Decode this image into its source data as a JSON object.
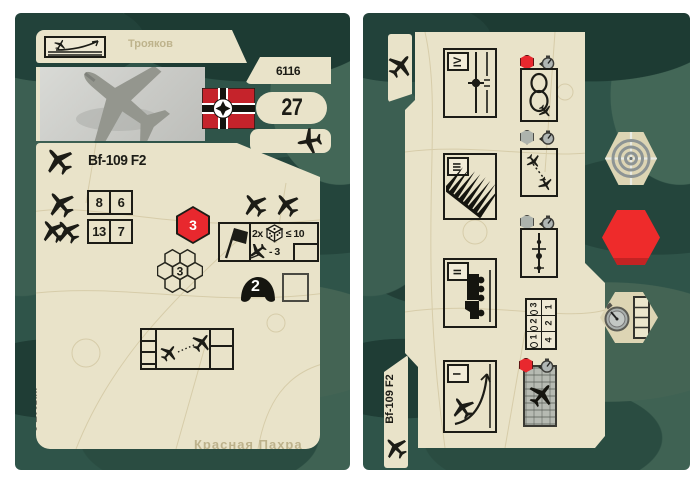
{
  "colors": {
    "page_bg": "#ffffff",
    "camo_base": "#2f5449",
    "camo_dark": "#1d3b33",
    "camo_light": "#436757",
    "card_beige": "#e9e3c9",
    "accent_red": "#e8282e",
    "ink": "#1c1c16"
  },
  "left_card": {
    "unit_code": "6116",
    "point_value": "27",
    "title": "Bf-109 F2",
    "icons": {
      "climb": "aircraft-climb-icon",
      "photo": "aircraft-photo",
      "flag": "german-war-flag-icon",
      "type": "aircraft-icon"
    },
    "stats": [
      {
        "icon": "single-aircraft-icon",
        "values": [
          "8",
          "6"
        ]
      },
      {
        "icon": "paired-aircraft-icon",
        "values": [
          "13",
          "7"
        ]
      }
    ],
    "initiative_hex": "3",
    "formation_hex": "3",
    "attack_panel": {
      "flag_icon": "assault-flag-icon",
      "multiplier": "2x",
      "dice_icon": "dice-icon",
      "threshold": "≤ 10",
      "strafe_icon": "strafing-aircraft-icon",
      "modifier": "- 3"
    },
    "morale_helmet": "2",
    "copyright": "© Zvezda",
    "map_labels": [
      "Трояков",
      "Красная Пахра"
    ]
  },
  "right_card": {
    "tab_icon": "aircraft-icon",
    "title": "Bf-109 F2",
    "phases": [
      {
        "numeral": "IV",
        "icon": "patrol-flight-icon"
      },
      {
        "numeral": "III",
        "icon": "gunfire-icon"
      },
      {
        "numeral": "II",
        "icon": "supply-truck-icon"
      },
      {
        "numeral": "I",
        "icon": "takeoff-icon"
      }
    ],
    "maneuvers": [
      {
        "marker": "red-hex",
        "timer": "stopwatch-icon",
        "icon": "loop-maneuver-icon"
      },
      {
        "marker": "gray-hex",
        "timer": "stopwatch-icon",
        "icon": "air-combat-icon"
      },
      {
        "marker": "gray-hex",
        "timer": "stopwatch-icon",
        "icon": "altitude-change-icon"
      },
      {
        "marker": "red-hex",
        "timer": "stopwatch-icon",
        "icon": "city-attack-icon"
      }
    ],
    "range_table": {
      "rows": [
        {
          "label": "3",
          "value": "1"
        },
        {
          "label": "2",
          "value": "2"
        },
        {
          "label": "1",
          "value": "4"
        }
      ]
    }
  },
  "tokens": {
    "target": "target-crosshair-token",
    "red_hex": "red-hexagon-token",
    "timer": "stopwatch-track-token"
  }
}
